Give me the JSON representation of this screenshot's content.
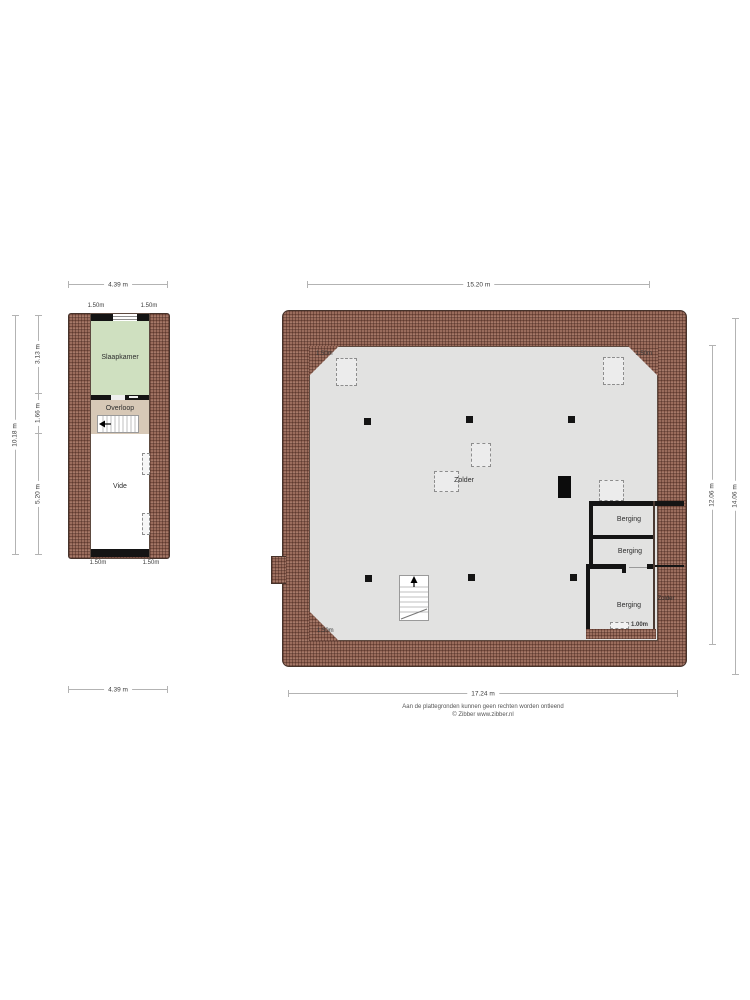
{
  "footer": {
    "disclaimer": "Aan de plattegronden kunnen geen rechten worden ontleend",
    "copyright": "© Zibber www.zibber.nl"
  },
  "small_plan": {
    "dim_top": "4.39 m",
    "dim_bottom": "4.39 m",
    "dim_left_total": "10.18 m",
    "dim_left_seg1": "3.13 m",
    "dim_left_seg2": "1.66 m",
    "dim_left_seg3": "5.20 m",
    "knee_top_left": "1.50m",
    "knee_top_right": "1.50m",
    "knee_bottom_left": "1.50m",
    "knee_bottom_right": "1.50m",
    "room_slaapkamer": "Slaapkamer",
    "room_overloop": "Overloop",
    "room_vide": "Vide"
  },
  "large_plan": {
    "dim_top": "15.20 m",
    "dim_bottom": "17.24 m",
    "dim_right_inner": "12.06 m",
    "dim_right_outer": "14.06 m",
    "knee_top_left": "1.50m",
    "knee_top_right": "1.50m",
    "knee_bottom_left": "1.50m",
    "knee_berging": "1.00m",
    "room_zolder": "Zolder",
    "room_zolder_side": "Zolder",
    "room_berging_1": "Berging",
    "room_berging_2": "Berging",
    "room_berging_3": "Berging"
  },
  "colors": {
    "roof_hatch": "#9a6c5c",
    "floor_gray": "#e2e2e1",
    "room_green": "#cfe0c0",
    "room_tan": "#d7c8b6",
    "wall_black": "#141414"
  }
}
